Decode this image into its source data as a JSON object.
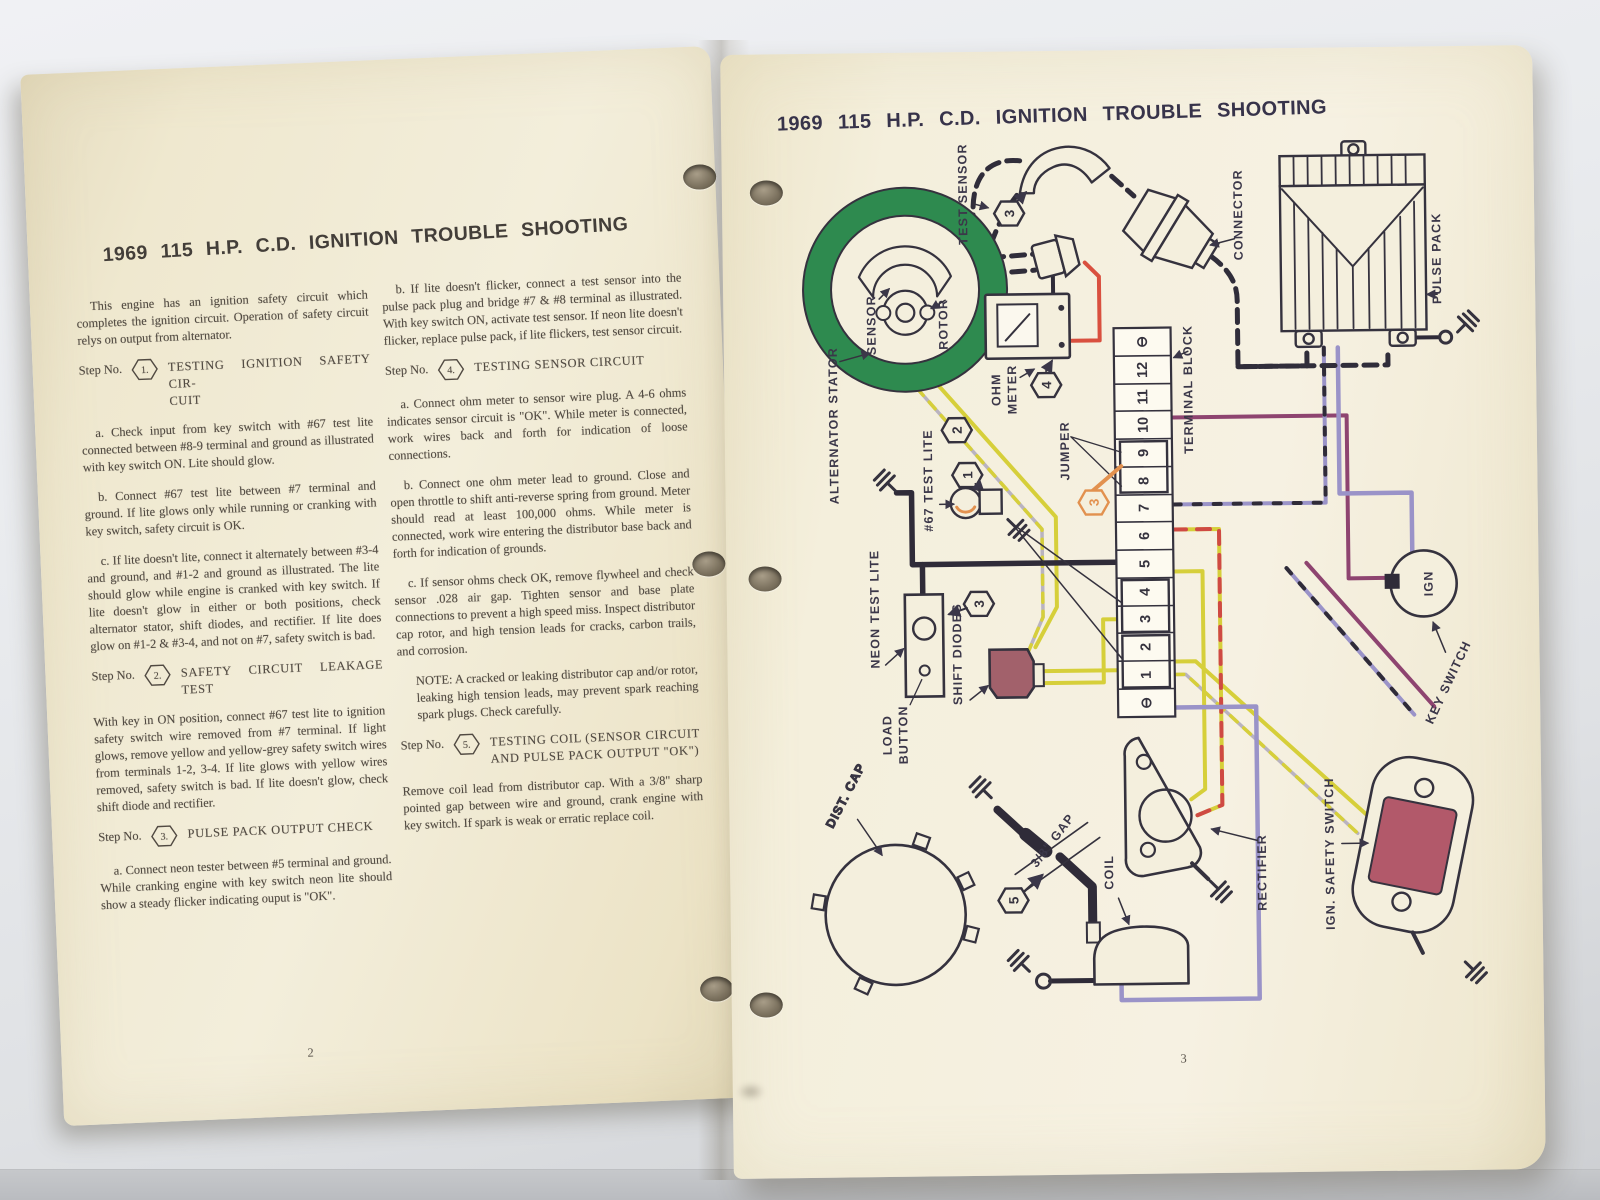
{
  "left_page": {
    "page_number": "2",
    "title": "1969  115 H.P.  C.D.  IGNITION  TROUBLE  SHOOTING",
    "intro": "This engine has an ignition safety circuit which completes the ignition circuit.  Operation of safety circuit relys on output from alternator.",
    "step_prefix": "Step No.",
    "step1": {
      "num": "1.",
      "heading": "TESTING IGNITION SAFETY CIR-\nCUIT"
    },
    "p1a": "a.  Check input from key switch with #67 test lite connected between #8-9 terminal and ground as illustrated with key switch ON.  Lite should glow.",
    "p1b": "b.  Connect #67 test lite between #7 terminal and ground.  If lite glows only while running or cranking with key switch, safety circuit is OK.",
    "p1c": "c.  If lite doesn't lite, connect it alternately between #3-4 and ground, and #1-2 and ground as illustrated. The lite should glow while engine is cranked with key switch.  If lite doesn't glow in either or both positions, check alternator stator, shift diodes, and rectifier.  If lite does glow on #1-2 & #3-4, and not on #7, safety switch is bad.",
    "step2": {
      "num": "2.",
      "heading": "SAFETY CIRCUIT LEAKAGE TEST"
    },
    "p2": "With key in ON position, connect #67 test lite to ignition safety switch wire removed from #7 terminal. If light glows, remove yellow and yellow-grey safety switch wires from terminals 1-2, 3-4.  If lite glows with yellow wires removed, safety switch is bad.  If lite doesn't glow, check shift diode and rectifier.",
    "step3": {
      "num": "3.",
      "heading": "PULSE PACK OUTPUT CHECK"
    },
    "p3a": "a.  Connect neon tester between #5 terminal and ground.  While cranking engine with key switch neon lite should show a steady flicker indicating ouput is \"OK\".",
    "p3b": "b. If lite doesn't flicker, connect a test sensor into the pulse pack plug and bridge #7 & #8 terminal as illustrated.  With key switch ON, activate test sensor. If neon lite doesn't flicker, replace pulse pack, if lite flickers, test sensor circuit.",
    "step4": {
      "num": "4.",
      "heading": "TESTING SENSOR CIRCUIT"
    },
    "p4a": "a.  Connect ohm meter to sensor wire plug.  A 4-6 ohms indicates sensor circuit is \"OK\".  While meter is connected, work wires back and forth for indication of loose connections.",
    "p4b": "b.  Connect one ohm meter lead to ground.  Close and open throttle to shift anti-reverse spring from ground.  Meter should read at least 100,000 ohms. While meter is connected, work wire entering the distributor base back and forth for indication of grounds.",
    "p4c": "c.  If sensor ohms check OK, remove flywheel and check sensor .028 air gap.  Tighten sensor and base plate connections to prevent a high speed miss.  Inspect distributor cap rotor, and high tension leads for cracks, carbon trails, and corrosion.",
    "note": "NOTE:  A cracked or leaking distributor cap and/or rotor, leaking high tension leads, may prevent spark reaching spark plugs.  Check carefully.",
    "step5": {
      "num": "5.",
      "heading": "TESTING COIL  (SENSOR CIRCUIT\nAND PULSE PACK OUTPUT \"OK\")"
    },
    "p5": "Remove coil lead from distributor cap.  With a 3/8\" sharp pointed gap between wire and ground, crank engine with key switch.  If spark is weak or erratic replace coil."
  },
  "right_page": {
    "page_number": "3",
    "title": "1969  115 H.P.  C.D.  IGNITION  TROUBLE  SHOOTING",
    "diagram": {
      "alternator_stator": "ALTERNATOR STATOR",
      "sensor": "SENSOR",
      "rotor": "ROTOR",
      "test_sensor": "TEST SENSOR",
      "connector": "CONNECTOR",
      "pulse_pack": "PULSE PACK",
      "ohm_meter": [
        "OHM",
        "METER"
      ],
      "terminal_block": "TERMINAL BLOCK",
      "jumper": "JUMPER",
      "test_lite_67": "#67 TEST LITE",
      "neon_test_lite": "NEON TEST LITE",
      "load_button": [
        "LOAD",
        "BUTTON"
      ],
      "shift_diodes": "SHIFT DIODES",
      "dist_cap": "DIST. CAP",
      "gap": "3/8\" GAP",
      "coil": "COIL",
      "rectifier": "RECTIFIER",
      "ign_safety_switch": "IGN. SAFETY SWITCH",
      "key_switch": "KEY SWITCH",
      "ign": "IGN",
      "markers": {
        "m1": "1",
        "m2": "2",
        "m3_test_sensor": "3",
        "m3_neon": "3",
        "m3_jumper": "3",
        "m4": "4",
        "m5": "5"
      },
      "terminal_block_cells": [
        "⊖",
        "12",
        "11",
        "10",
        "9",
        "8",
        "7",
        "6",
        "5",
        "4",
        "3",
        "2",
        "1",
        "⊖"
      ]
    },
    "colors": {
      "stator_green": "#2e8a4f",
      "wire_yellow": "#d6cf3a",
      "wire_red": "#d9503f",
      "jumper_orange": "#e2914f",
      "wire_lavender": "#9a93c8",
      "wire_plum": "#8e4470",
      "ink": "#35323e",
      "diode_maroon": "#a2616b",
      "switch_red": "#b2596a"
    }
  }
}
